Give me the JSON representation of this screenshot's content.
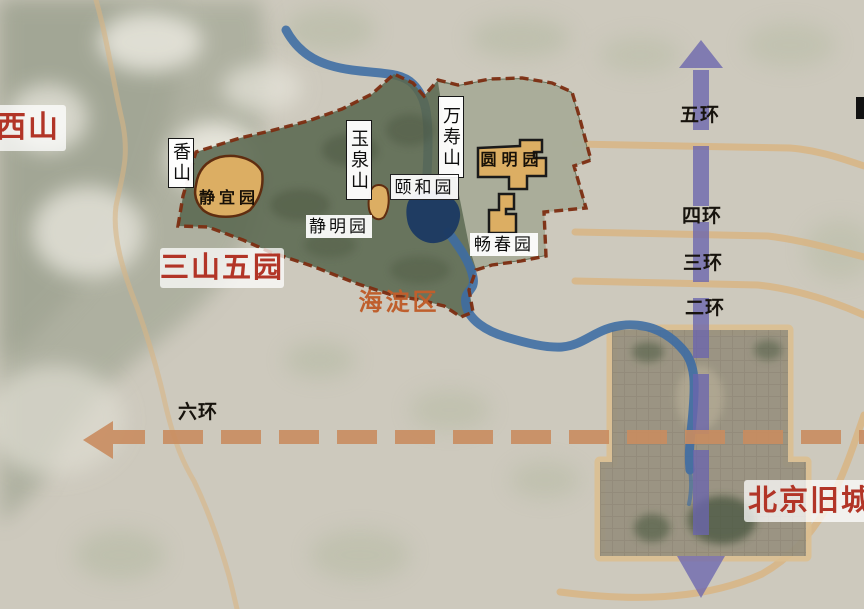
{
  "region_labels": {
    "xishan": "西山",
    "sanshanwuyuan": "三山五园",
    "haidian": "海淀区",
    "beijing_old_city": "北京旧城"
  },
  "hill_labels": {
    "xiangshan": "香山",
    "yuquanshan": "玉泉山",
    "wanshoushan": "万寿山"
  },
  "garden_labels": {
    "jingyiyuan": "静宜园",
    "jingmingyuan": "静明园",
    "yiheyuan": "颐和园",
    "yuanmingyuan": "圆明园",
    "changchunyuan": "畅春园"
  },
  "ring_road_labels": {
    "ring2": "二环",
    "ring3": "三环",
    "ring4": "四环",
    "ring5": "五环",
    "ring6": "六环"
  },
  "colors": {
    "accent_red": "#b23527",
    "haidian_orange": "#bf5f2d",
    "boundary_dashed": "#7c2d11",
    "garden_fill": "#dcae63",
    "garden_green": "#5a6850",
    "river_blue": "#3c6ca4",
    "lake_navy": "#1c3a63",
    "ring_road_tan": "#d9b584",
    "axis_purple": "#6b66ae",
    "axis_orange": "#c98c60"
  }
}
